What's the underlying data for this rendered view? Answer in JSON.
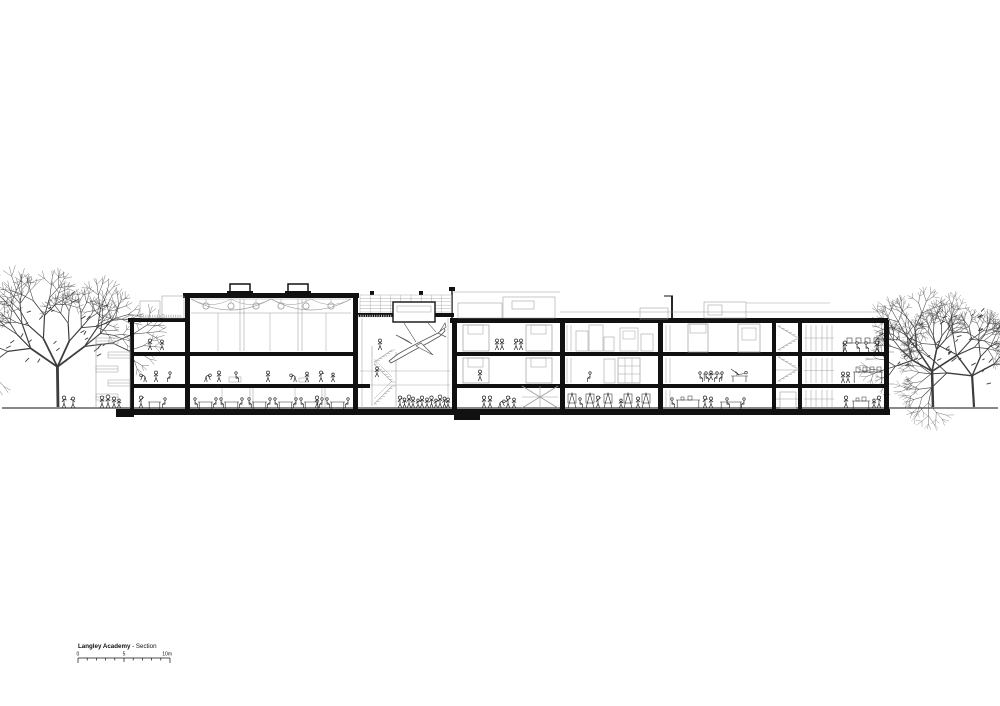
{
  "sheet": {
    "background": "#ffffff"
  },
  "palette": {
    "ink": "#111111",
    "detail": "#9b9b9b",
    "figure": "#2a2a2a",
    "tree": "#3d3d3d",
    "hatch": "#bbbbbb"
  },
  "title_block": {
    "project": "Langley Academy",
    "drawing_label": " - Section"
  },
  "scale_bar": {
    "zero": "0",
    "mid": "5",
    "end": "10m",
    "divisions": 10
  },
  "drawing": {
    "subject": "Building cross-section with suspended aircraft in atrium, trees and people",
    "label": "Langley Academy - Section"
  }
}
